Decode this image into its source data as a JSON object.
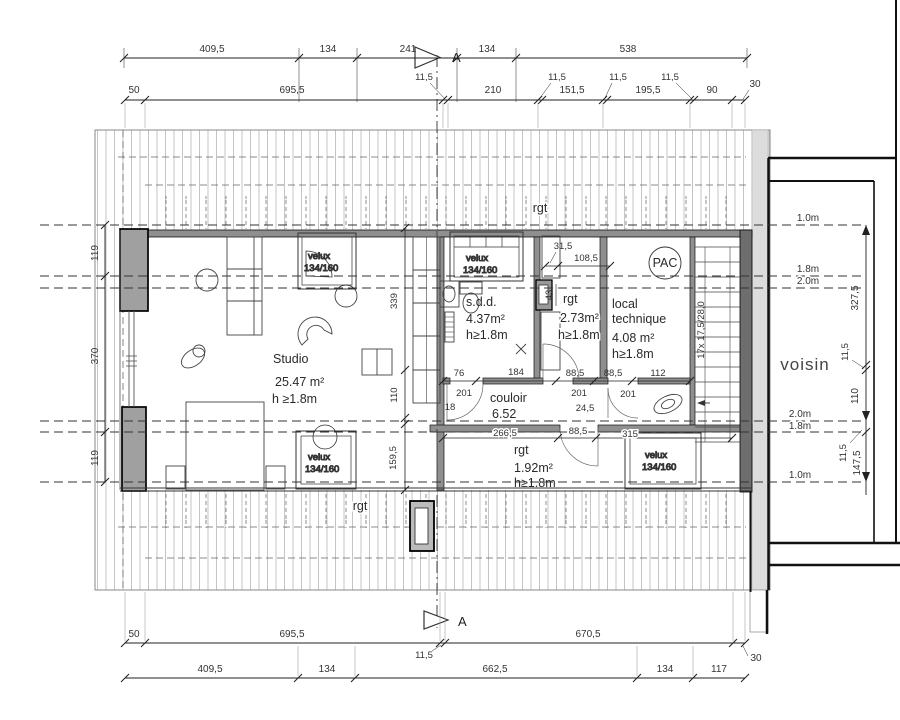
{
  "plan": {
    "section_marker": "A",
    "neighbor_label": "voisin",
    "pac_label": "PAC",
    "stair_label": "17x 17,5/28,0",
    "storage_top": "rgt",
    "storage_bottom": "rgt",
    "velux": {
      "name": "velux",
      "size": "134/160"
    },
    "rooms": {
      "studio": {
        "name": "Studio",
        "area": "25.47 m²",
        "height": "h ≥1.8m"
      },
      "sdd": {
        "name": "s.d.d.",
        "area": "4.37m²",
        "height": "h≥1.8m"
      },
      "rgt_small": {
        "name": "rgt",
        "area": "2.73m²",
        "height": "h≥1.8m"
      },
      "local_technique": {
        "line1": "local",
        "line2": "technique",
        "area": "4.08 m²",
        "height": "h≥1.8m"
      },
      "couloir": {
        "name": "couloir",
        "area": "6.52"
      },
      "rgt_back": {
        "name": "rgt",
        "area": "1.92m²",
        "height": "h≥1.8m"
      }
    },
    "heights": {
      "m10": "1.0m",
      "m18": "1.8m",
      "m20": "2.0m"
    },
    "dims": {
      "top_row1": [
        "409,5",
        "134",
        "241",
        "134",
        "538"
      ],
      "top_row2": [
        "50",
        "695,5",
        "210",
        "151,5",
        "195,5",
        "90",
        "30"
      ],
      "offset": "11,5",
      "bottom_row1": [
        "50",
        "695,5",
        "670,5",
        "30"
      ],
      "bottom_row2": [
        "409,5",
        "134",
        "662,5",
        "134",
        "117"
      ],
      "left": [
        "119",
        "370",
        "119"
      ],
      "right": [
        "327,5",
        "110",
        "147,5"
      ],
      "mid_vertical": [
        "339",
        "110",
        "159,5"
      ],
      "corridor_top": [
        "76",
        "184",
        "88,5",
        "88,5",
        "112"
      ],
      "corridor_bottom": [
        "266,5",
        "88,5",
        "315"
      ],
      "door_heights": [
        "201",
        "18",
        "201",
        "24,5",
        "201"
      ],
      "sdd_top": [
        "31,5",
        "108,5"
      ],
      "shaft_width": "43"
    }
  }
}
